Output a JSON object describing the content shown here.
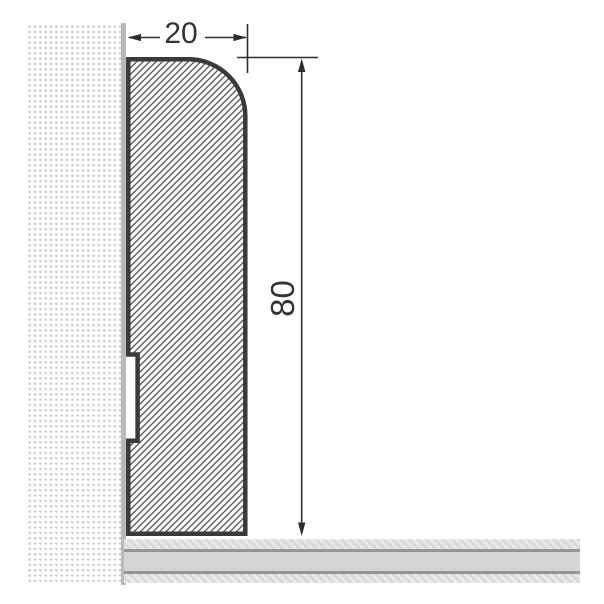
{
  "diagram": {
    "type": "technical-cross-section",
    "subject": "skirting-board profile mounted at wall and floor junction",
    "dimensions": {
      "width": {
        "label": "20",
        "orientation": "horizontal",
        "measures": "profile width"
      },
      "height": {
        "label": "80",
        "orientation": "vertical",
        "measures": "profile height"
      }
    },
    "features": {
      "profile-hatch": "diagonal-45deg",
      "wall-pattern": "stippled-dots",
      "floor-pattern": "layered-bands",
      "corner": "rounded-top-right",
      "back-groove": "rectangular-rebate-lower-left"
    }
  },
  "colors": {
    "background": "#ffffff",
    "profile-outline": "#3a3a3a",
    "hatch-line": "#4a4a4a",
    "hatch-bg": "#ffffff",
    "dim-line": "#2e2e2e",
    "dim-text": "#333333",
    "wall-dot": "#c9c9c9",
    "wall-edge": "#b9b9b9",
    "floor-line": "#979797",
    "floor-mid": "#d5d5d5",
    "floor-hatch-a": "#e9e9e9",
    "floor-hatch-b": "#d9d9d9"
  }
}
